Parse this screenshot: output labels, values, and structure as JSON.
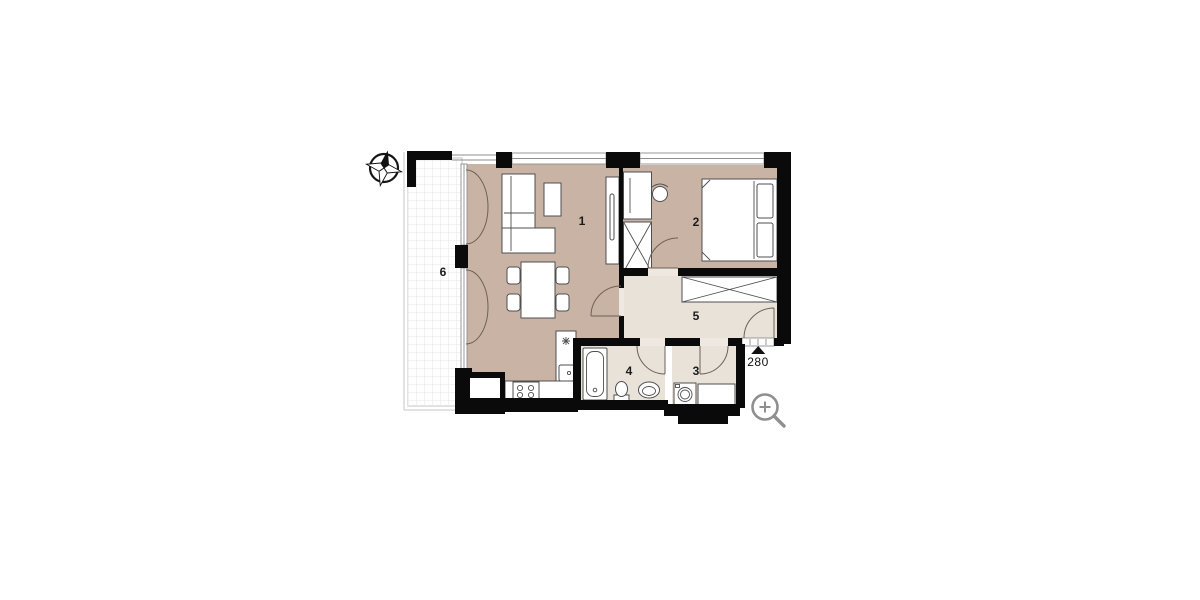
{
  "colors": {
    "wall": "#0a0a0a",
    "room_main": "#c9b3a5",
    "room_light": "#e8e2d9",
    "terrace_grid": "#e6e6e6",
    "furniture_line": "#4f4f4f",
    "door_line": "#6b6257",
    "window_line": "#8f8f8f",
    "icon_gray": "#8f8f8f",
    "label_text": "#1b1b1b"
  },
  "floor_plan": {
    "rooms": [
      {
        "id": "room-1",
        "label": "1"
      },
      {
        "id": "room-2",
        "label": "2"
      },
      {
        "id": "room-3",
        "label": "3"
      },
      {
        "id": "room-4",
        "label": "4"
      },
      {
        "id": "room-5",
        "label": "5"
      },
      {
        "id": "room-6",
        "label": "6"
      }
    ],
    "entrance": {
      "label": "280"
    }
  },
  "icons": {
    "compass": "north-compass-rose",
    "zoom_control": "zoom-in-magnifier"
  }
}
